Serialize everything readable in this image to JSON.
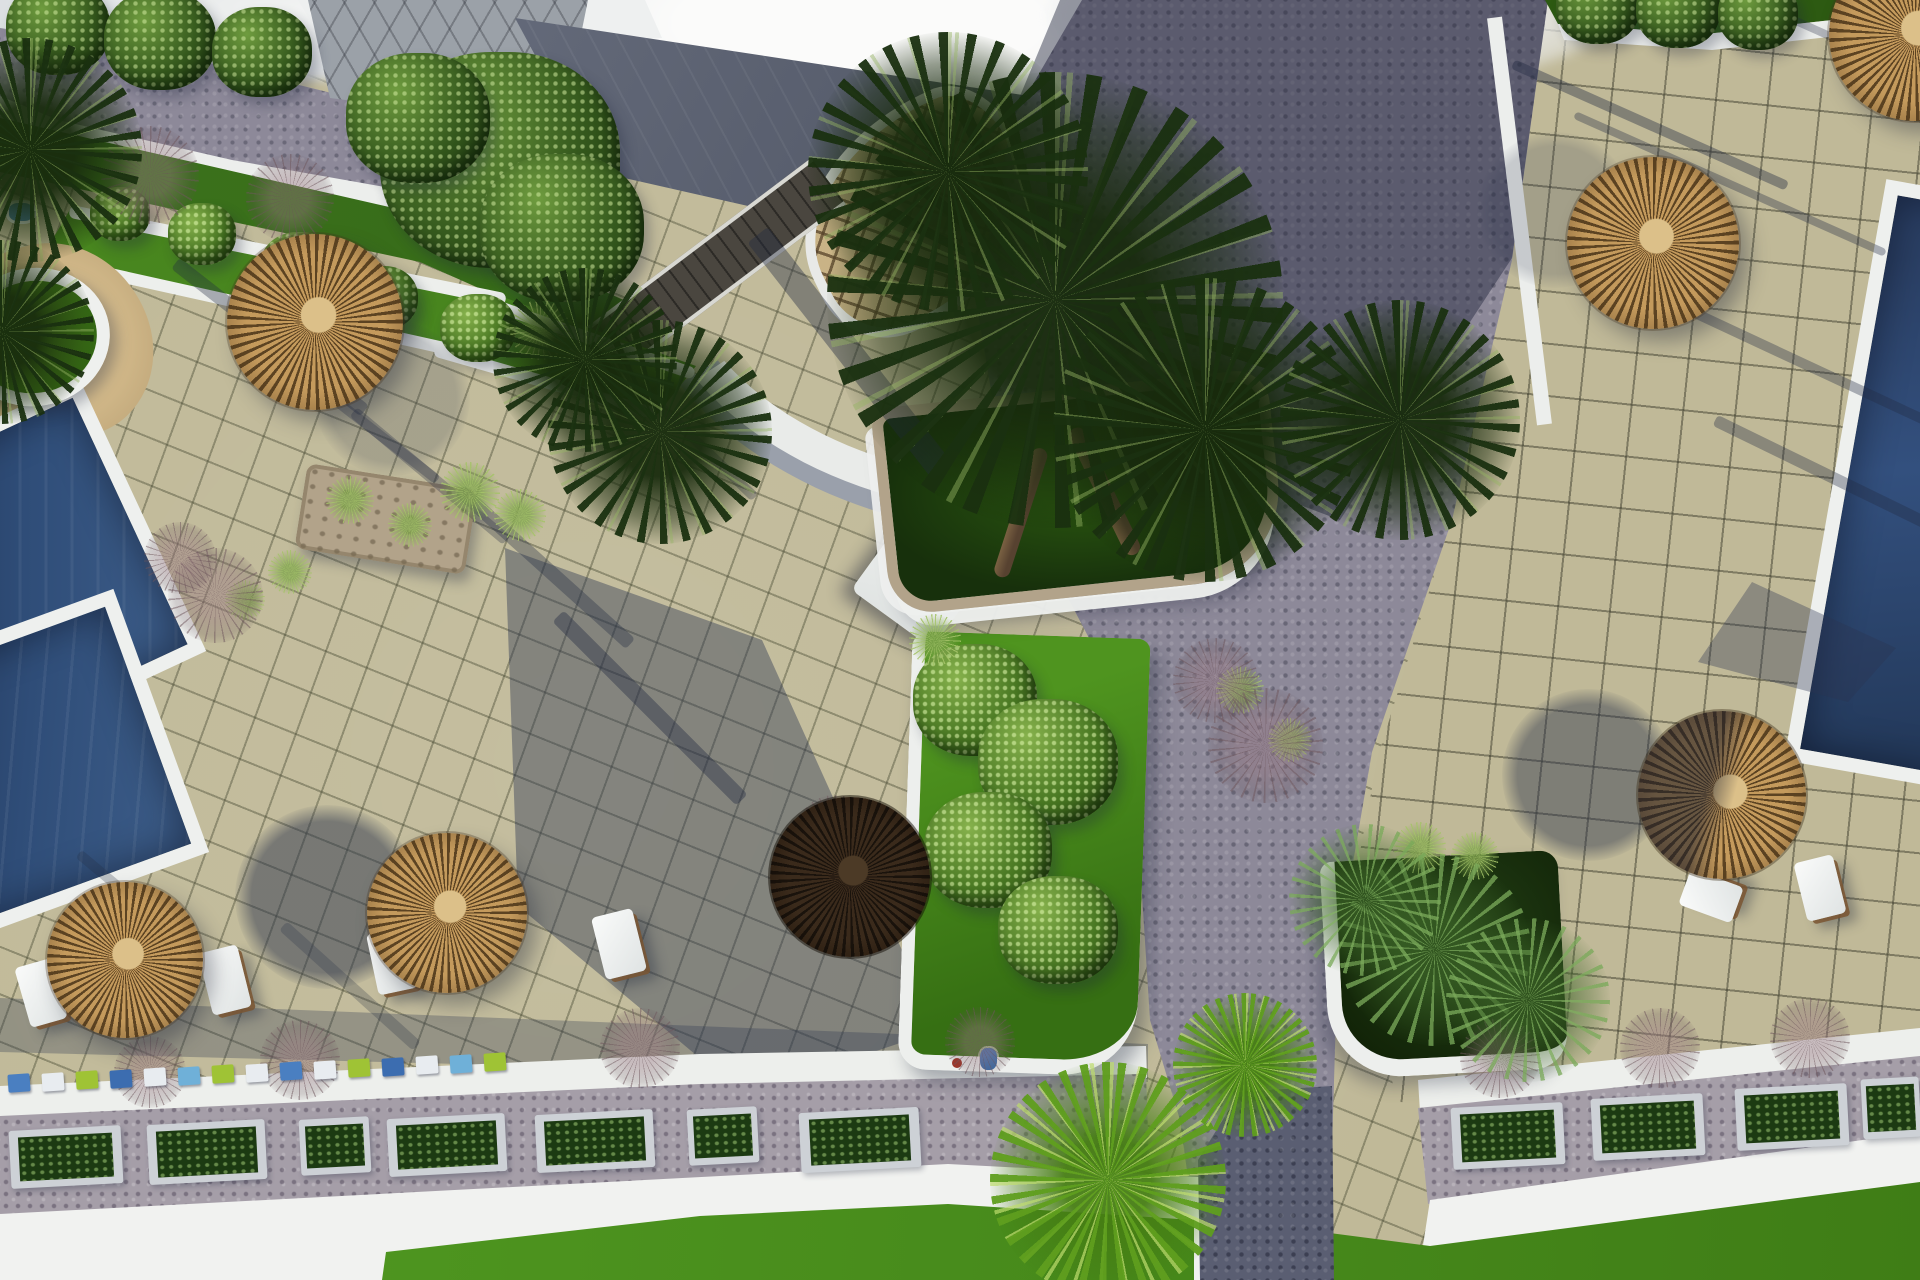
{
  "meta": {
    "description": "Aerial 3D architectural rendering of a resort pool deck: beige paved terraces with grid joints, cobbled grey walkways, two dark-blue swimming pools, thatched straw parasols with white sun loungers, palm trees in stone planters, green lawn beds with white curbs, and a bottom promenade with rectangular shrub planters.",
    "no_visible_text": true
  },
  "colors": {
    "paving": "#c0b998",
    "paving_line": "#56584a",
    "cobble": "#8d8999",
    "cobble_dark": "#5a5e72",
    "gravel": "#a59ea8",
    "curb_white": "#eef0ee",
    "lawn": "#58a226",
    "hedge": "#1d3b10",
    "canopy_green": "#22381a",
    "palm_bright": "#6fb32b",
    "straw": "#c49a5c",
    "straw_dark": "#7c5c33",
    "straw_hub": "#dcc089",
    "umbrella_dark": "#2e2117",
    "pool_water": "#2e4568",
    "roof_tan": "#c9b386",
    "roof_chevron": "#57432a",
    "slate_roof": "#5c6272",
    "sand": "#d3b988",
    "stone": "#b2a38a",
    "shadow_blue": "#2c3550"
  },
  "scene": {
    "umbrellas": [
      {
        "x": 315,
        "y": 322,
        "r": 88,
        "variant": "sunlit"
      },
      {
        "x": 447,
        "y": 913,
        "r": 80,
        "variant": "sunlit"
      },
      {
        "x": 125,
        "y": 960,
        "r": 78,
        "variant": "sunlit"
      },
      {
        "x": 850,
        "y": 877,
        "r": 80,
        "variant": "dark"
      },
      {
        "x": 1722,
        "y": 795,
        "r": 84,
        "variant": "half"
      },
      {
        "x": 1653,
        "y": 243,
        "r": 86,
        "variant": "sunlit"
      },
      {
        "x": 1915,
        "y": 35,
        "r": 86,
        "variant": "sunlit"
      }
    ],
    "umbrella_shadows": [
      {
        "x": 327,
        "y": 897,
        "r": 92,
        "o": 0.9
      },
      {
        "x": 1588,
        "y": 775,
        "r": 86,
        "o": 0.8
      },
      {
        "x": 1555,
        "y": 210,
        "r": 78,
        "o": 0.35
      },
      {
        "x": 392,
        "y": 398,
        "r": 78,
        "o": 0.35
      }
    ],
    "loungers": [
      {
        "x": 205,
        "y": 948,
        "w": 40,
        "h": 64,
        "rot": -14
      },
      {
        "x": 372,
        "y": 930,
        "w": 40,
        "h": 62,
        "rot": -12
      },
      {
        "x": 22,
        "y": 962,
        "w": 38,
        "h": 62,
        "rot": -16
      },
      {
        "x": 598,
        "y": 912,
        "w": 42,
        "h": 64,
        "rot": -14
      },
      {
        "x": 1800,
        "y": 858,
        "w": 40,
        "h": 60,
        "rot": -14
      },
      {
        "x": 1692,
        "y": 868,
        "w": 38,
        "h": 56,
        "rot": -70
      }
    ],
    "planter_boxes": [
      {
        "x": 10,
        "y": 1128,
        "w": 112,
        "h": 58
      },
      {
        "x": 148,
        "y": 1122,
        "w": 118,
        "h": 60
      },
      {
        "x": 300,
        "y": 1118,
        "w": 70,
        "h": 56
      },
      {
        "x": 388,
        "y": 1116,
        "w": 118,
        "h": 58
      },
      {
        "x": 536,
        "y": 1112,
        "w": 118,
        "h": 58
      },
      {
        "x": 688,
        "y": 1108,
        "w": 70,
        "h": 56
      },
      {
        "x": 800,
        "y": 1110,
        "w": 120,
        "h": 60
      },
      {
        "x": 1452,
        "y": 1105,
        "w": 112,
        "h": 62
      },
      {
        "x": 1592,
        "y": 1096,
        "w": 112,
        "h": 62
      },
      {
        "x": 1736,
        "y": 1086,
        "w": 112,
        "h": 62
      },
      {
        "x": 1862,
        "y": 1078,
        "w": 58,
        "h": 60
      }
    ],
    "cube_strip": {
      "start_x": 8,
      "start_y": 1074,
      "step_x": 34,
      "step_y": -1.5,
      "count": 15,
      "size": [
        22,
        18
      ],
      "palette": [
        "#4a7fc1",
        "#e8ecf0",
        "#9fc335",
        "#3c6db0",
        "#e8ecf0",
        "#6fb0d8",
        "#9fc335",
        "#e8ecf0"
      ]
    },
    "bushes": [
      {
        "x": 500,
        "y": 160,
        "r": 120,
        "tone": "dark"
      },
      {
        "x": 418,
        "y": 118,
        "r": 72,
        "tone": "dark"
      },
      {
        "x": 562,
        "y": 228,
        "r": 82,
        "tone": "dark"
      },
      {
        "x": 975,
        "y": 700,
        "r": 62,
        "tone": "mid"
      },
      {
        "x": 1048,
        "y": 762,
        "r": 70,
        "tone": "mid"
      },
      {
        "x": 988,
        "y": 850,
        "r": 64,
        "tone": "mid"
      },
      {
        "x": 1058,
        "y": 930,
        "r": 60,
        "tone": "mid"
      },
      {
        "x": 300,
        "y": 268,
        "r": 40,
        "tone": "mid"
      },
      {
        "x": 382,
        "y": 298,
        "r": 36,
        "tone": "mid"
      },
      {
        "x": 202,
        "y": 234,
        "r": 34,
        "tone": "mid"
      },
      {
        "x": 120,
        "y": 214,
        "r": 30,
        "tone": "mid"
      },
      {
        "x": 478,
        "y": 328,
        "r": 38,
        "tone": "mid"
      },
      {
        "x": 1598,
        "y": 6,
        "r": 42,
        "tone": "dark"
      },
      {
        "x": 1678,
        "y": 10,
        "r": 42,
        "tone": "dark"
      },
      {
        "x": 1758,
        "y": 14,
        "r": 40,
        "tone": "dark"
      },
      {
        "x": 58,
        "y": 28,
        "r": 52,
        "tone": "dark"
      },
      {
        "x": 160,
        "y": 40,
        "r": 56,
        "tone": "dark"
      },
      {
        "x": 262,
        "y": 52,
        "r": 50,
        "tone": "dark"
      }
    ],
    "palm_canopies": [
      {
        "x": 1055,
        "y": 300,
        "r": 228,
        "hue": "dark"
      },
      {
        "x": 948,
        "y": 172,
        "r": 140,
        "hue": "dark"
      },
      {
        "x": 1205,
        "y": 430,
        "r": 152,
        "hue": "dark"
      },
      {
        "x": 660,
        "y": 432,
        "r": 112,
        "hue": "dark"
      },
      {
        "x": 585,
        "y": 360,
        "r": 92,
        "hue": "dark"
      },
      {
        "x": 1400,
        "y": 420,
        "r": 120,
        "hue": "dark"
      },
      {
        "x": 30,
        "y": 150,
        "r": 112,
        "hue": "dark"
      },
      {
        "x": 2,
        "y": 332,
        "r": 92,
        "hue": "dark"
      },
      {
        "x": 1108,
        "y": 1180,
        "r": 118,
        "hue": "bright"
      },
      {
        "x": 1245,
        "y": 1065,
        "r": 72,
        "hue": "bright"
      },
      {
        "x": 1435,
        "y": 950,
        "r": 96,
        "hue": "fern"
      },
      {
        "x": 1528,
        "y": 1000,
        "r": 82,
        "hue": "fern"
      },
      {
        "x": 1365,
        "y": 900,
        "r": 76,
        "hue": "fern"
      }
    ],
    "twig_shrubs": [
      {
        "x": 215,
        "y": 595,
        "s": 95
      },
      {
        "x": 180,
        "y": 558,
        "s": 72
      },
      {
        "x": 1265,
        "y": 745,
        "s": 115
      },
      {
        "x": 1215,
        "y": 680,
        "s": 85
      },
      {
        "x": 835,
        "y": 835,
        "s": 80
      },
      {
        "x": 150,
        "y": 1072,
        "s": 72
      },
      {
        "x": 300,
        "y": 1060,
        "s": 80
      },
      {
        "x": 640,
        "y": 1048,
        "s": 80
      },
      {
        "x": 980,
        "y": 1042,
        "s": 70
      },
      {
        "x": 1500,
        "y": 1058,
        "s": 80
      },
      {
        "x": 1660,
        "y": 1048,
        "s": 80
      },
      {
        "x": 1810,
        "y": 1038,
        "s": 80
      },
      {
        "x": 150,
        "y": 175,
        "s": 98
      },
      {
        "x": 290,
        "y": 198,
        "s": 88
      }
    ],
    "grass_tufts": [
      {
        "x": 540,
        "y": 330,
        "r": 30
      },
      {
        "x": 592,
        "y": 362,
        "r": 26
      },
      {
        "x": 470,
        "y": 492,
        "r": 30
      },
      {
        "x": 520,
        "y": 515,
        "r": 26
      },
      {
        "x": 350,
        "y": 500,
        "r": 24
      },
      {
        "x": 410,
        "y": 525,
        "r": 22
      },
      {
        "x": 1420,
        "y": 848,
        "r": 26
      },
      {
        "x": 1475,
        "y": 856,
        "r": 24
      },
      {
        "x": 290,
        "y": 572,
        "r": 22
      },
      {
        "x": 245,
        "y": 600,
        "r": 20
      },
      {
        "x": 935,
        "y": 640,
        "r": 26
      },
      {
        "x": 1240,
        "y": 690,
        "r": 24
      },
      {
        "x": 1290,
        "y": 740,
        "r": 22
      }
    ],
    "shadow_streaks": [
      {
        "x": 150,
        "y": 330,
        "len": 240,
        "rot": 38,
        "w": 14,
        "o": 0.35
      },
      {
        "x": 205,
        "y": 395,
        "len": 260,
        "rot": 38,
        "w": 10,
        "o": 0.3
      },
      {
        "x": 330,
        "y": 470,
        "len": 200,
        "rot": 40,
        "w": 12,
        "o": 0.3
      },
      {
        "x": 430,
        "y": 560,
        "len": 230,
        "rot": 42,
        "w": 14,
        "o": 0.35
      },
      {
        "x": 520,
        "y": 700,
        "len": 260,
        "rot": 45,
        "w": 16,
        "o": 0.4
      },
      {
        "x": 600,
        "y": 430,
        "len": 180,
        "rot": 44,
        "w": 10,
        "o": 0.3
      },
      {
        "x": 1500,
        "y": 120,
        "len": 300,
        "rot": 24,
        "w": 10,
        "o": 0.4
      },
      {
        "x": 1560,
        "y": 180,
        "len": 340,
        "rot": 24,
        "w": 8,
        "o": 0.35
      },
      {
        "x": 1620,
        "y": 350,
        "len": 330,
        "rot": 25,
        "w": 10,
        "o": 0.35
      },
      {
        "x": 1700,
        "y": 480,
        "len": 300,
        "rot": 26,
        "w": 12,
        "o": 0.35
      },
      {
        "x": 1760,
        "y": 50,
        "len": 220,
        "rot": 24,
        "w": 8,
        "o": 0.3
      },
      {
        "x": 60,
        "y": 900,
        "len": 160,
        "rot": 40,
        "w": 10,
        "o": 0.25
      },
      {
        "x": 260,
        "y": 980,
        "len": 180,
        "rot": 42,
        "w": 12,
        "o": 0.25
      },
      {
        "x": 700,
        "y": 340,
        "len": 300,
        "rot": 52,
        "w": 26,
        "o": 0.4
      }
    ],
    "palm_trunks": [
      {
        "x": 120,
        "y": 40,
        "w": 16,
        "h": 135,
        "rot": 24
      },
      {
        "x": 205,
        "y": 25,
        "w": 17,
        "h": 140,
        "rot": -20
      }
    ]
  }
}
